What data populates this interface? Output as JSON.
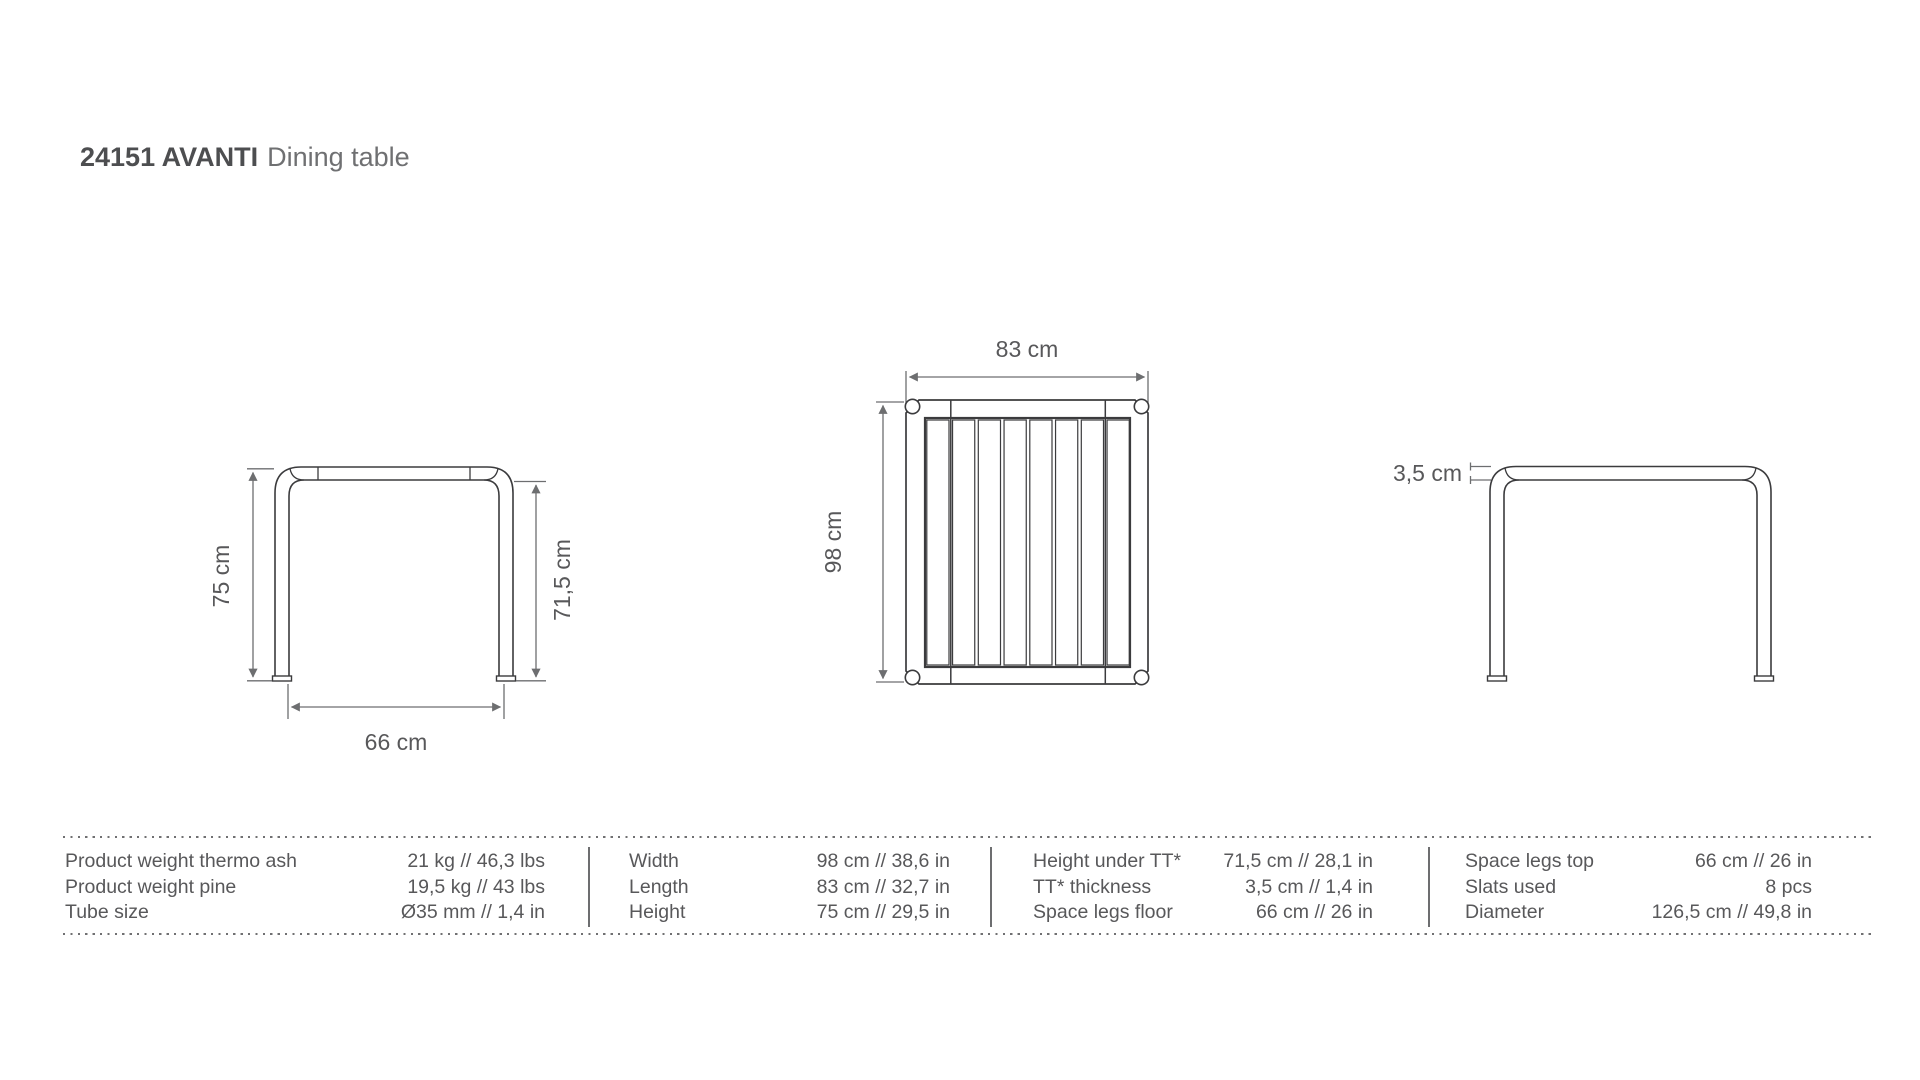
{
  "title": {
    "bold": "24151 AVANTI",
    "regular": "Dining table"
  },
  "drawings": {
    "front_view": {
      "height_label": "75 cm",
      "height_under_top_label": "71,5 cm",
      "space_legs_label": "66 cm"
    },
    "top_view": {
      "length_label": "83 cm",
      "width_label": "98 cm",
      "slat_count": 8
    },
    "side_view": {
      "tabletop_thickness_label": "3,5 cm"
    }
  },
  "spec_table": {
    "columns": [
      {
        "rows": [
          {
            "label": "Product weight thermo ash",
            "value": "21 kg // 46,3 lbs"
          },
          {
            "label": "Product weight pine",
            "value": "19,5 kg // 43 lbs"
          },
          {
            "label": "Tube size",
            "value": "Ø35 mm // 1,4 in"
          }
        ]
      },
      {
        "rows": [
          {
            "label": "Width",
            "value": "98 cm // 38,6 in"
          },
          {
            "label": "Length",
            "value": "83 cm // 32,7 in"
          },
          {
            "label": "Height",
            "value": "75 cm // 29,5 in"
          }
        ]
      },
      {
        "rows": [
          {
            "label": "Height under TT*",
            "value": "71,5 cm // 28,1 in"
          },
          {
            "label": "TT* thickness",
            "value": "3,5 cm // 1,4 in"
          },
          {
            "label": "Space legs floor",
            "value": "66 cm // 26 in"
          }
        ]
      },
      {
        "rows": [
          {
            "label": "Space legs top",
            "value": "66 cm // 26 in"
          },
          {
            "label": "Slats used",
            "value": "8 pcs"
          },
          {
            "label": "Diameter",
            "value": "126,5 cm // 49,8 in"
          }
        ]
      }
    ]
  },
  "colors": {
    "drawing_line": "#3b3b3d",
    "dimension_line": "#6d6e70",
    "text": "#58585a",
    "title_bold": "#4d4e50",
    "title_regular": "#6f7072"
  }
}
